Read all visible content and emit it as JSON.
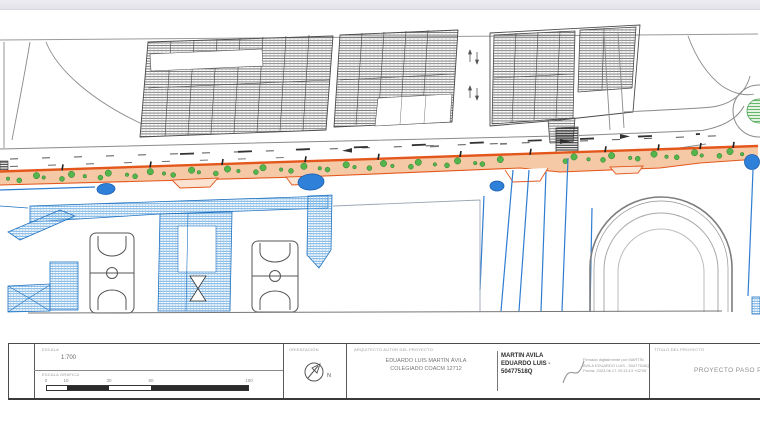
{
  "colors": {
    "project_strip_orange": "#e4571c",
    "project_strip_fill": "#f5c9a6",
    "existing_blue": "#2e7dd1",
    "tree_green": "#54b54a",
    "hatch_gray": "#6e6e6e"
  },
  "title_block": {
    "scale": {
      "label": "ESCALA",
      "value": "1:700",
      "graphic_label": "ESCALA GRAFICA",
      "ticks": [
        "0",
        "10",
        "30",
        "50",
        "100"
      ]
    },
    "orientation": {
      "label": "ORIENTACIÓN",
      "north": "N"
    },
    "architect": {
      "label": "ARQUITECTO AUTOR DEL PROYECTO",
      "name": "EDUARDO LUIS MARTÍN ÁVILA",
      "college": "COLEGIADO COACM 12712"
    },
    "signature": {
      "name": "MARTIN AVILA\nEDUARDO LUIS -\n50477518Q",
      "details": "Firmado digitalmente por MARTÍN\nAVILA EDUARDO LUIS - 50477518Q\nFecha: 2023.06.17 20:13:13 +02'00'"
    },
    "project": {
      "label": "TÍTULO DEL PROYECTO",
      "value": "PROYECTO PASO PEA"
    }
  }
}
